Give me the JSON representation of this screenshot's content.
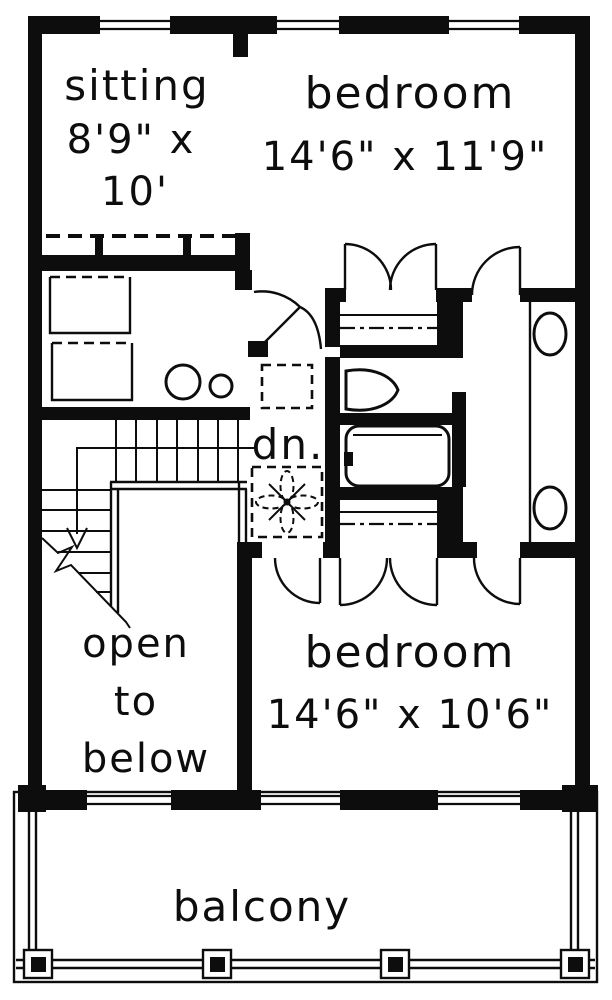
{
  "colors": {
    "ink": "#0d0d0d",
    "paper": "#ffffff"
  },
  "labels": {
    "sitting": {
      "name": "sitting",
      "dim1": "8'9\" x",
      "dim2": "10'"
    },
    "bedroom_top": {
      "name": "bedroom",
      "dims": "14'6\" x 11'9\""
    },
    "bedroom_bottom": {
      "name": "bedroom",
      "dims": "14'6\" x 10'6\""
    },
    "stairs": {
      "down_label": "dn."
    },
    "open_below": {
      "word1": "open",
      "word2": "to",
      "word3": "below"
    },
    "balcony": {
      "name": "balcony"
    }
  }
}
